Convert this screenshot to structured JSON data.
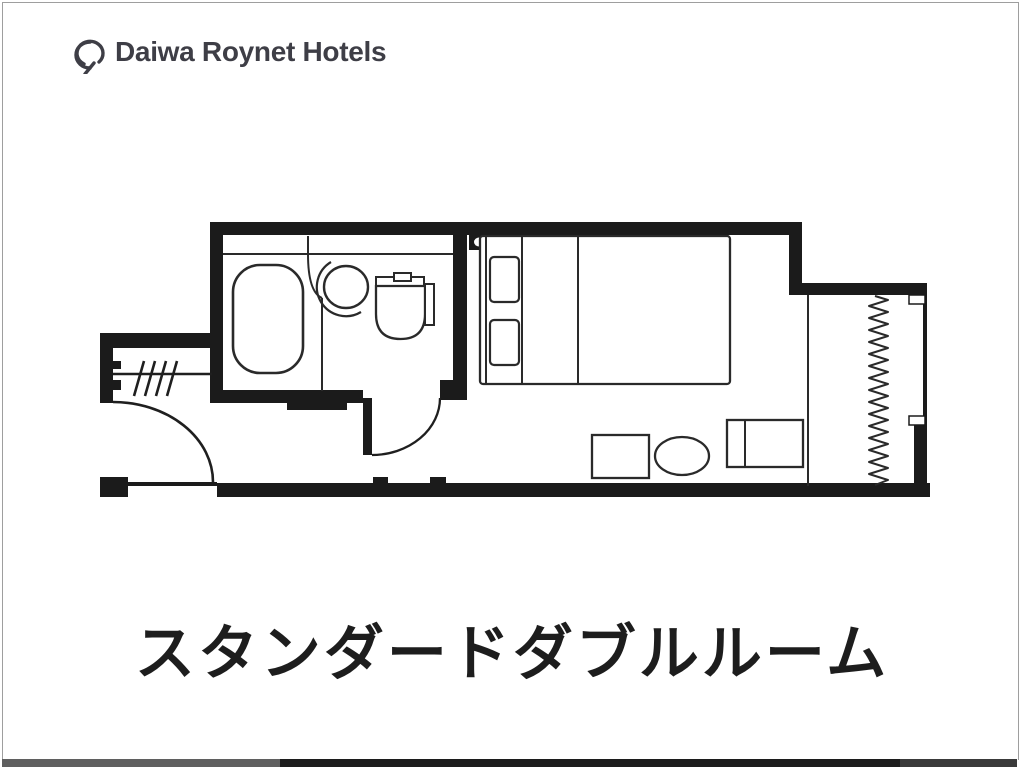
{
  "page": {
    "background_color": "#ffffff",
    "border_color": "#9e9e9e",
    "bottom_bar_colors": [
      "#5f5f5f",
      "#1c1c1c",
      "#3a3a3a"
    ]
  },
  "header": {
    "logo_icon": "daiwa-roynet-monogram-icon",
    "brand": "Daiwa Roynet Hotels",
    "brand_color": "#3e3e46"
  },
  "floor_plan": {
    "type": "hotel-room-floor-plan",
    "ink_color": "#1b1b1b",
    "line_color": "#2a2a2a",
    "rooms": [
      "entrance",
      "bathroom",
      "bedroom"
    ],
    "fixtures": [
      {
        "name": "entrance-door"
      },
      {
        "name": "hanger-rack"
      },
      {
        "name": "bathtub"
      },
      {
        "name": "washbasin"
      },
      {
        "name": "toilet"
      },
      {
        "name": "bathroom-door"
      },
      {
        "name": "double-bed"
      },
      {
        "name": "pillow",
        "count": 2
      },
      {
        "name": "wall-switch"
      },
      {
        "name": "desk"
      },
      {
        "name": "stool"
      },
      {
        "name": "luggage-rack"
      },
      {
        "name": "curtain"
      },
      {
        "name": "window"
      }
    ]
  },
  "caption": {
    "title": "スタンダードダブルルーム",
    "color": "#1d1d1d"
  }
}
